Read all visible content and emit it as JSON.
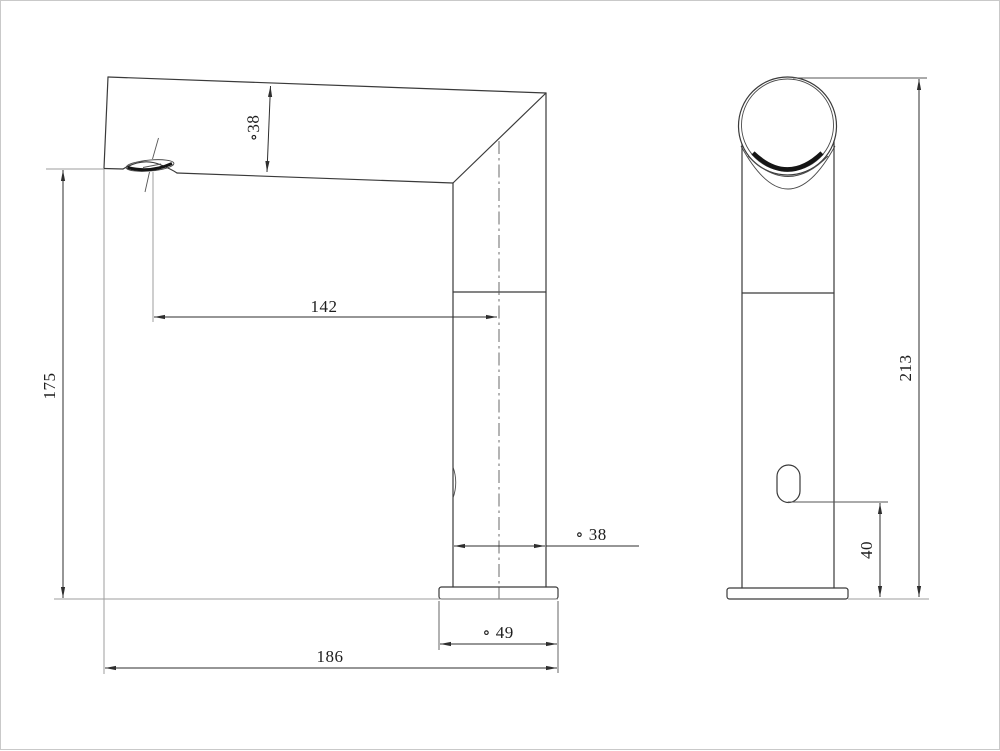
{
  "drawing": {
    "type": "technical-dimension-drawing",
    "subject": "automatic sensor basin faucet",
    "units": "mm",
    "background_color": "#ffffff",
    "line_color": "#3a3a3a",
    "views": {
      "side_view": {
        "name": "side elevation",
        "dimensions": {
          "spout_tube_diameter": {
            "label": "∘38",
            "orientation": "vertical"
          },
          "spout_reach": {
            "label": "142",
            "orientation": "horizontal"
          },
          "spout_height": {
            "label": "175",
            "orientation": "vertical"
          },
          "body_diameter": {
            "label": "∘ 38",
            "orientation": "horizontal"
          },
          "base_diameter": {
            "label": "∘ 49",
            "orientation": "horizontal"
          },
          "overall_depth": {
            "label": "186",
            "orientation": "horizontal"
          }
        }
      },
      "front_view": {
        "name": "front elevation",
        "dimensions": {
          "overall_height": {
            "label": "213",
            "orientation": "vertical"
          },
          "sensor_height": {
            "label": "40",
            "orientation": "vertical"
          }
        }
      }
    }
  }
}
